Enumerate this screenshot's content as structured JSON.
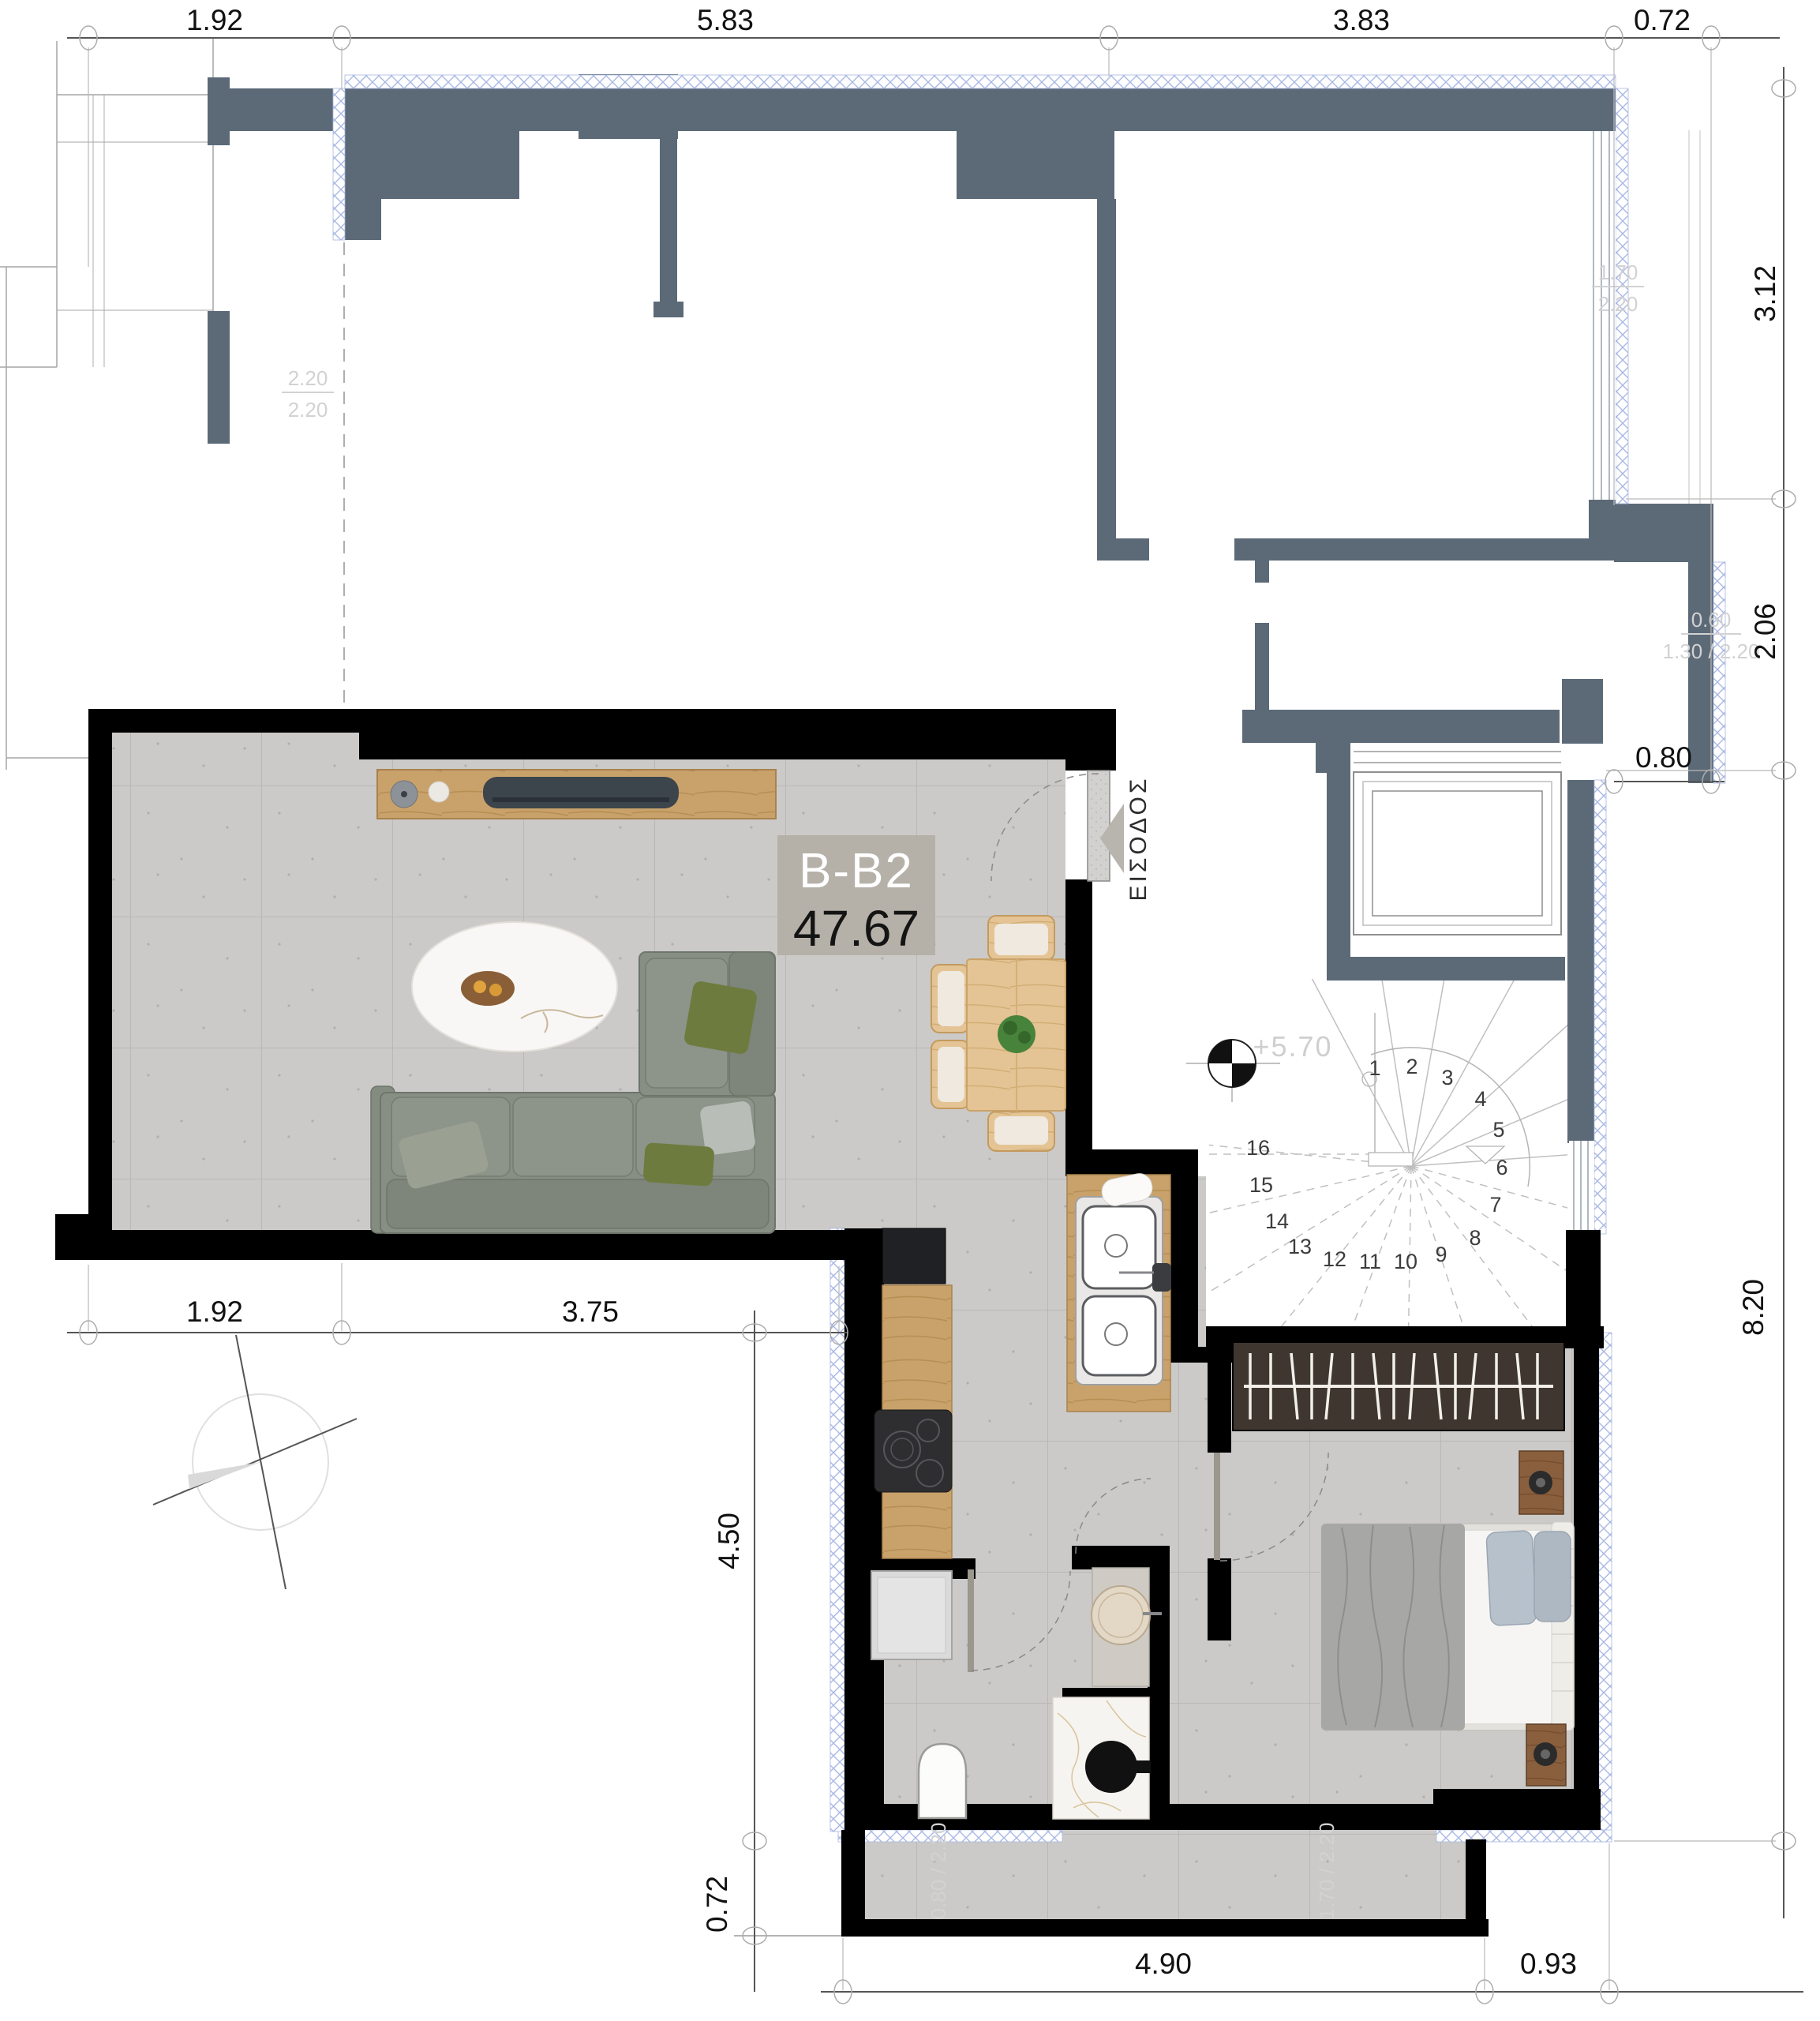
{
  "unit": {
    "label": "B-B2",
    "area": "47.67"
  },
  "entrance": {
    "label": "ΕΙΣΟΔΟΣ"
  },
  "level_marker": {
    "value": "+5.70"
  },
  "stairs": {
    "steps": [
      "1",
      "2",
      "3",
      "4",
      "5",
      "6",
      "7",
      "8",
      "9",
      "10",
      "11",
      "12",
      "13",
      "14",
      "15",
      "16"
    ]
  },
  "dimensions": {
    "top": [
      "1.92",
      "5.83",
      "3.83",
      "0.72"
    ],
    "right": [
      "3.12",
      "2.06",
      "0.80",
      "8.20"
    ],
    "middle": [
      "1.92",
      "3.75"
    ],
    "left_vertical": [
      "4.50",
      "0.72"
    ],
    "bottom": [
      "4.90",
      "0.93"
    ]
  },
  "window_annotations": {
    "left_numerator": "2.20",
    "left_denominator": "2.20",
    "top_right_numerator": "1.70",
    "top_right_denominator": "2.20",
    "right_line1": "0.60",
    "right_line2": "1.30 / 2.20",
    "bottom_window": "1.70 / 2.20",
    "bottom_door": "0.80 / 2.20"
  },
  "colors": {
    "wall_black": "#000000",
    "wall_gray": "#5c6a78",
    "insulation": "#a9b8e3",
    "tile": "#cbcac8",
    "label_bg": "#b3afa7",
    "wood": "#c9a26b"
  }
}
